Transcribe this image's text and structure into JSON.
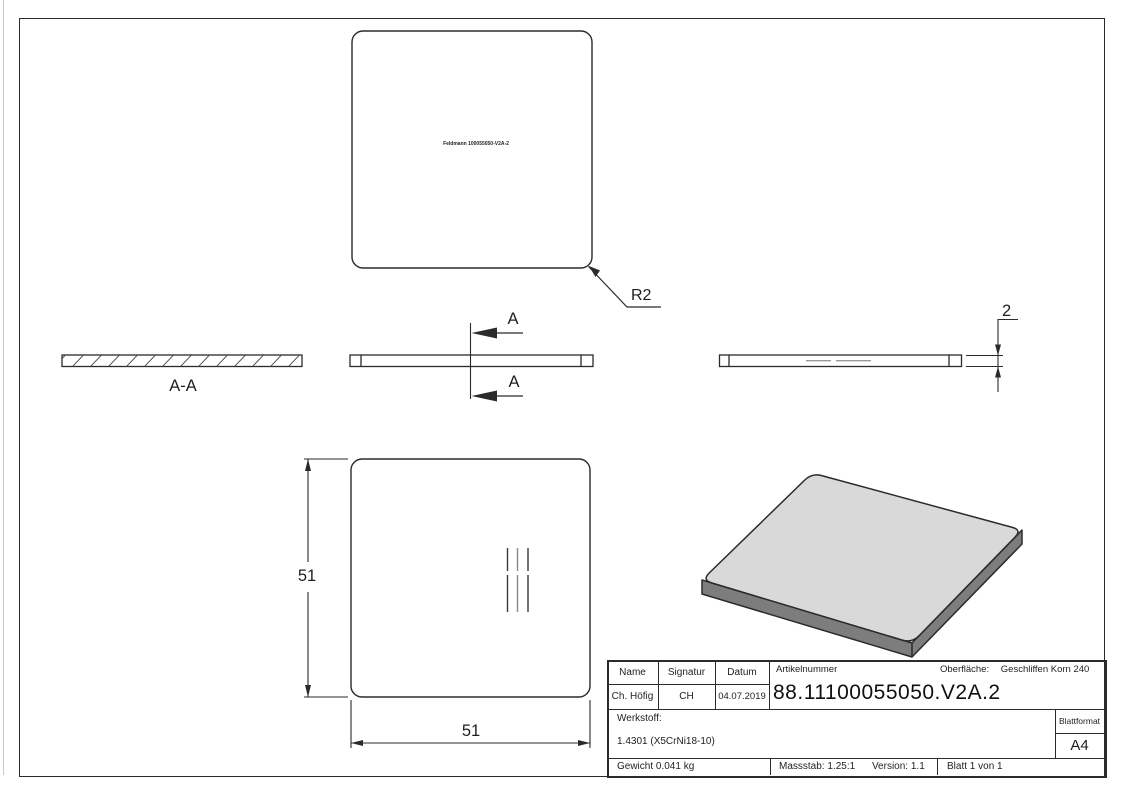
{
  "drawing": {
    "top_view": {
      "marking_text": "Feldmann 100055050-V2A-2",
      "radius_label": "R2"
    },
    "section_view": {
      "label": "A-A"
    },
    "section_cut": {
      "label_top": "A",
      "label_bottom": "A"
    },
    "side_view": {
      "thickness": "2"
    },
    "front_view": {
      "height": "51",
      "width": "51"
    }
  },
  "title_block": {
    "name_header": "Name",
    "signatur_header": "Signatur",
    "datum_header": "Datum",
    "name_value": "Ch. Höfig",
    "signatur_value": "CH",
    "datum_value": "04.07.2019",
    "artikelnummer_label": "Artikelnummer",
    "artikelnummer_value": "88.11100055050.V2A.2",
    "oberflaeche_label": "Oberfläche:",
    "oberflaeche_value": "Geschliffen Korn 240",
    "werkstoff_label": "Werkstoff:",
    "werkstoff_value": "1.4301 (X5CrNi18-10)",
    "blattformat_label": "Blattformat",
    "blattformat_value": "A4",
    "gewicht_value": "Gewicht 0.041 kg",
    "massstab_value": "Massstab: 1.25:1",
    "version_value": "Version: 1.1",
    "blatt_value": "Blatt 1 von 1"
  },
  "colors": {
    "line": "#2b2b2b",
    "marking_gray": "#8a8a8a",
    "iso_top_face": "#d9d9d9",
    "iso_side_face": "#7d7d7d"
  }
}
